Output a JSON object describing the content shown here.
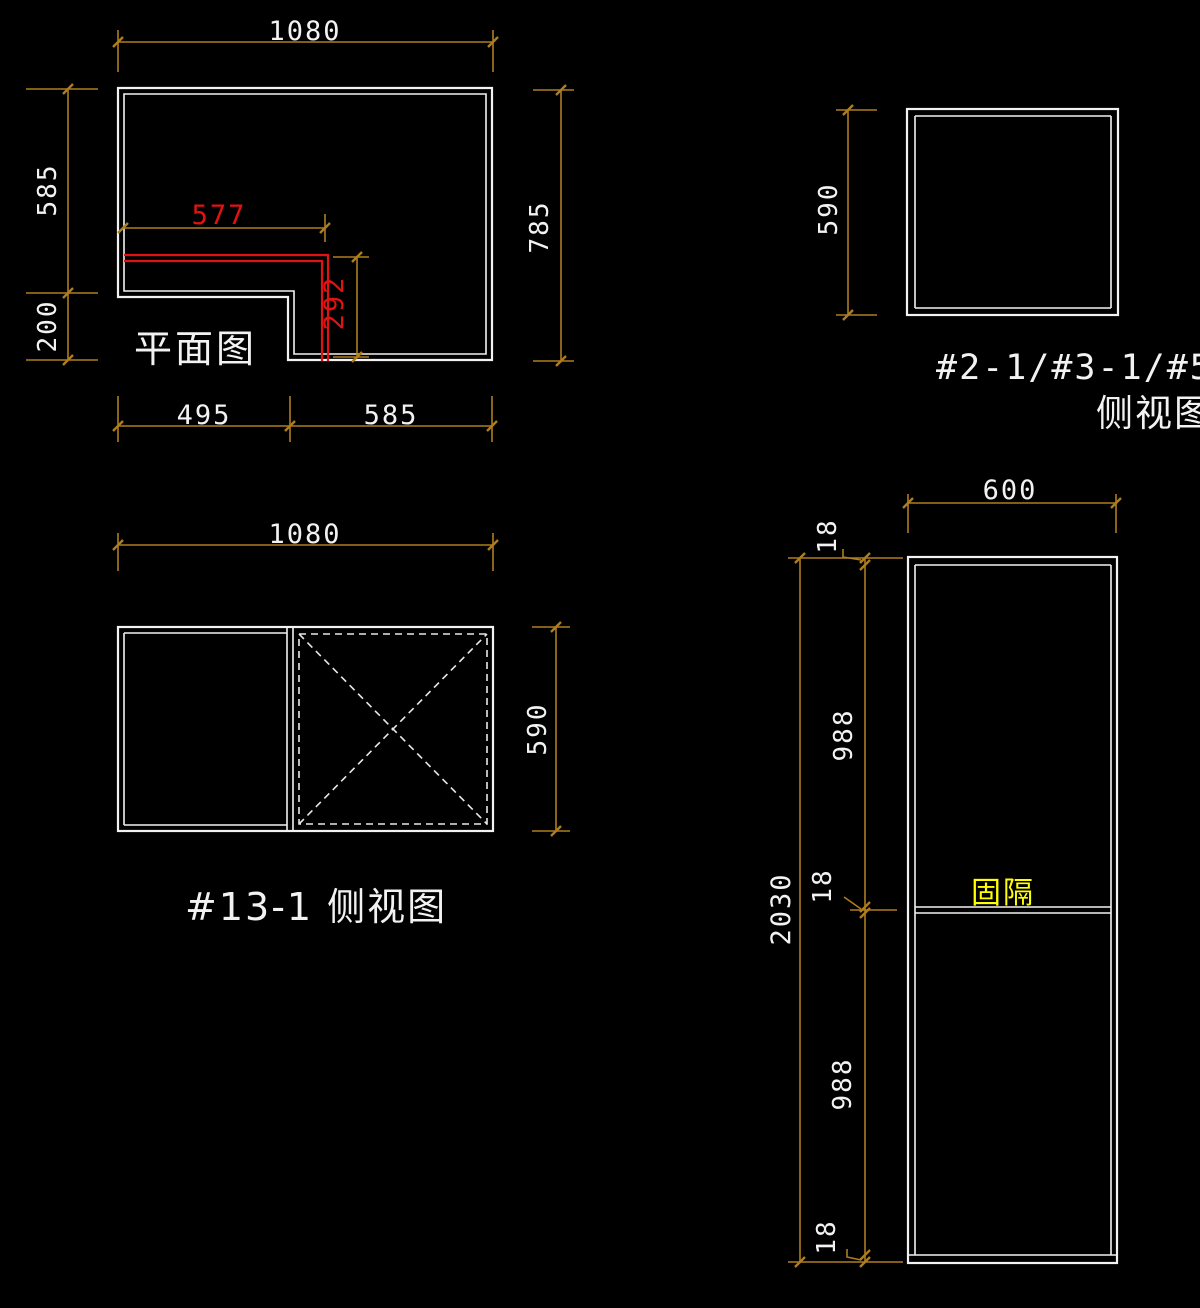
{
  "colors": {
    "background": "#000000",
    "drawing_line": "#f2f2f2",
    "dimension_line": "#ad7d1e",
    "highlight_red": "#e31212",
    "label_yellow": "#ffff00"
  },
  "plan": {
    "label": "平面图",
    "dim_top": "1080",
    "dim_left_upper": "585",
    "dim_left_lower": "200",
    "dim_right": "785",
    "dim_bottom_left": "495",
    "dim_bottom_right": "585",
    "dim_red_width": "577",
    "dim_red_depth": "292"
  },
  "small_side": {
    "label_ids": "#2-1/#3-1/#5-1",
    "label_view": "侧视图",
    "dim_left": "590"
  },
  "side_13": {
    "label": "#13-1 侧视图",
    "dim_top": "1080",
    "dim_right": "590"
  },
  "tall_cabinet": {
    "dim_top": "600",
    "dim_total_height": "2030",
    "dim_top_panel": "18",
    "dim_upper_section": "988",
    "dim_middle_panel": "18",
    "dim_lower_section": "988",
    "dim_bottom_panel": "18",
    "partition_label": "固隔"
  }
}
